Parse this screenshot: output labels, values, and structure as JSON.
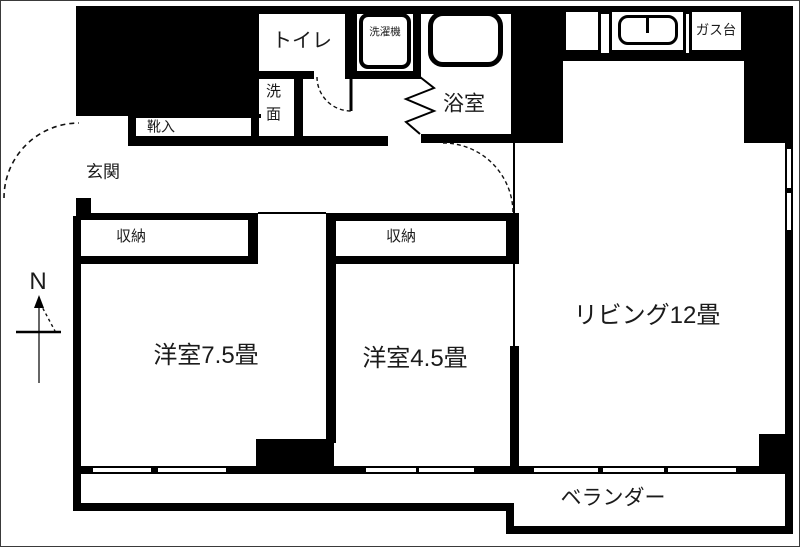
{
  "plan": {
    "type": "apartment-floor-plan",
    "labels": {
      "toilet": "トイレ",
      "washing_machine": "洗濯機",
      "bathroom": "浴室",
      "gas_stove": "ガス台",
      "entrance": "玄関",
      "shoe_cabinet": "靴入",
      "washbasin": "洗面",
      "storage_1": "収納",
      "storage_2": "収納",
      "western_room_75": "洋室7.5畳",
      "western_room_45": "洋室4.5畳",
      "living_room": "リビング12畳",
      "veranda": "ベランダー"
    },
    "compass": {
      "north_label": "N"
    },
    "colors": {
      "wall": "#000000",
      "background": "#ffffff",
      "text": "#1b1b1b"
    }
  }
}
